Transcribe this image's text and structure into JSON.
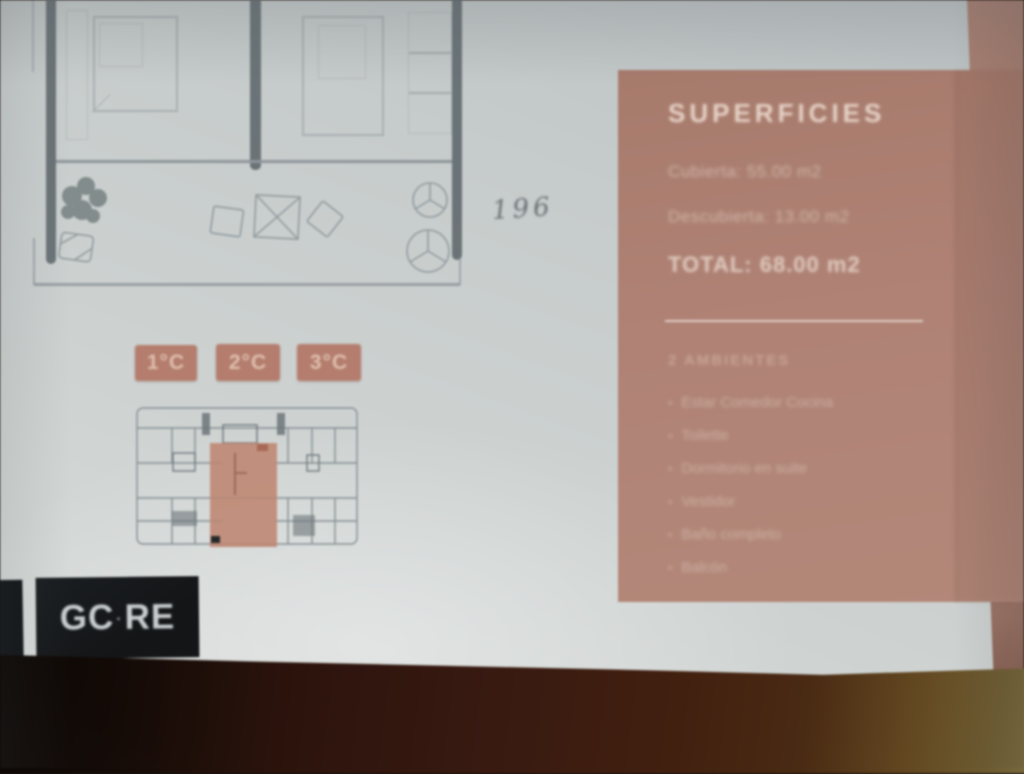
{
  "panel": {
    "title": "SUPERFICIES",
    "rows": [
      "Cubierta: 55.00 m2",
      "Descubierta: 13.00 m2"
    ],
    "total": "TOTAL: 68.00 m2",
    "ambientes_heading": "2 AMBIENTES",
    "bullet": "•",
    "items": [
      "Estar Comedor Cocina",
      "Toilette",
      "Dormitorio en suite",
      "Vestidor",
      "Baño completo",
      "Balcón"
    ]
  },
  "badges": [
    "1°C",
    "2°C",
    "3°C"
  ],
  "annotation": {
    "text": "196"
  },
  "logo": {
    "left": "GC",
    "separator": "·",
    "right": "RE"
  },
  "colors": {
    "panel": "#b08274",
    "badge": "#b67d6c",
    "keyplan_highlight": "#c08570",
    "paper": "#cdd2d1",
    "wood_dark": "#2c130c",
    "wood_light": "#7d6c3e",
    "logo_bg": "#16181b",
    "plan_wall": "#5d666b"
  }
}
